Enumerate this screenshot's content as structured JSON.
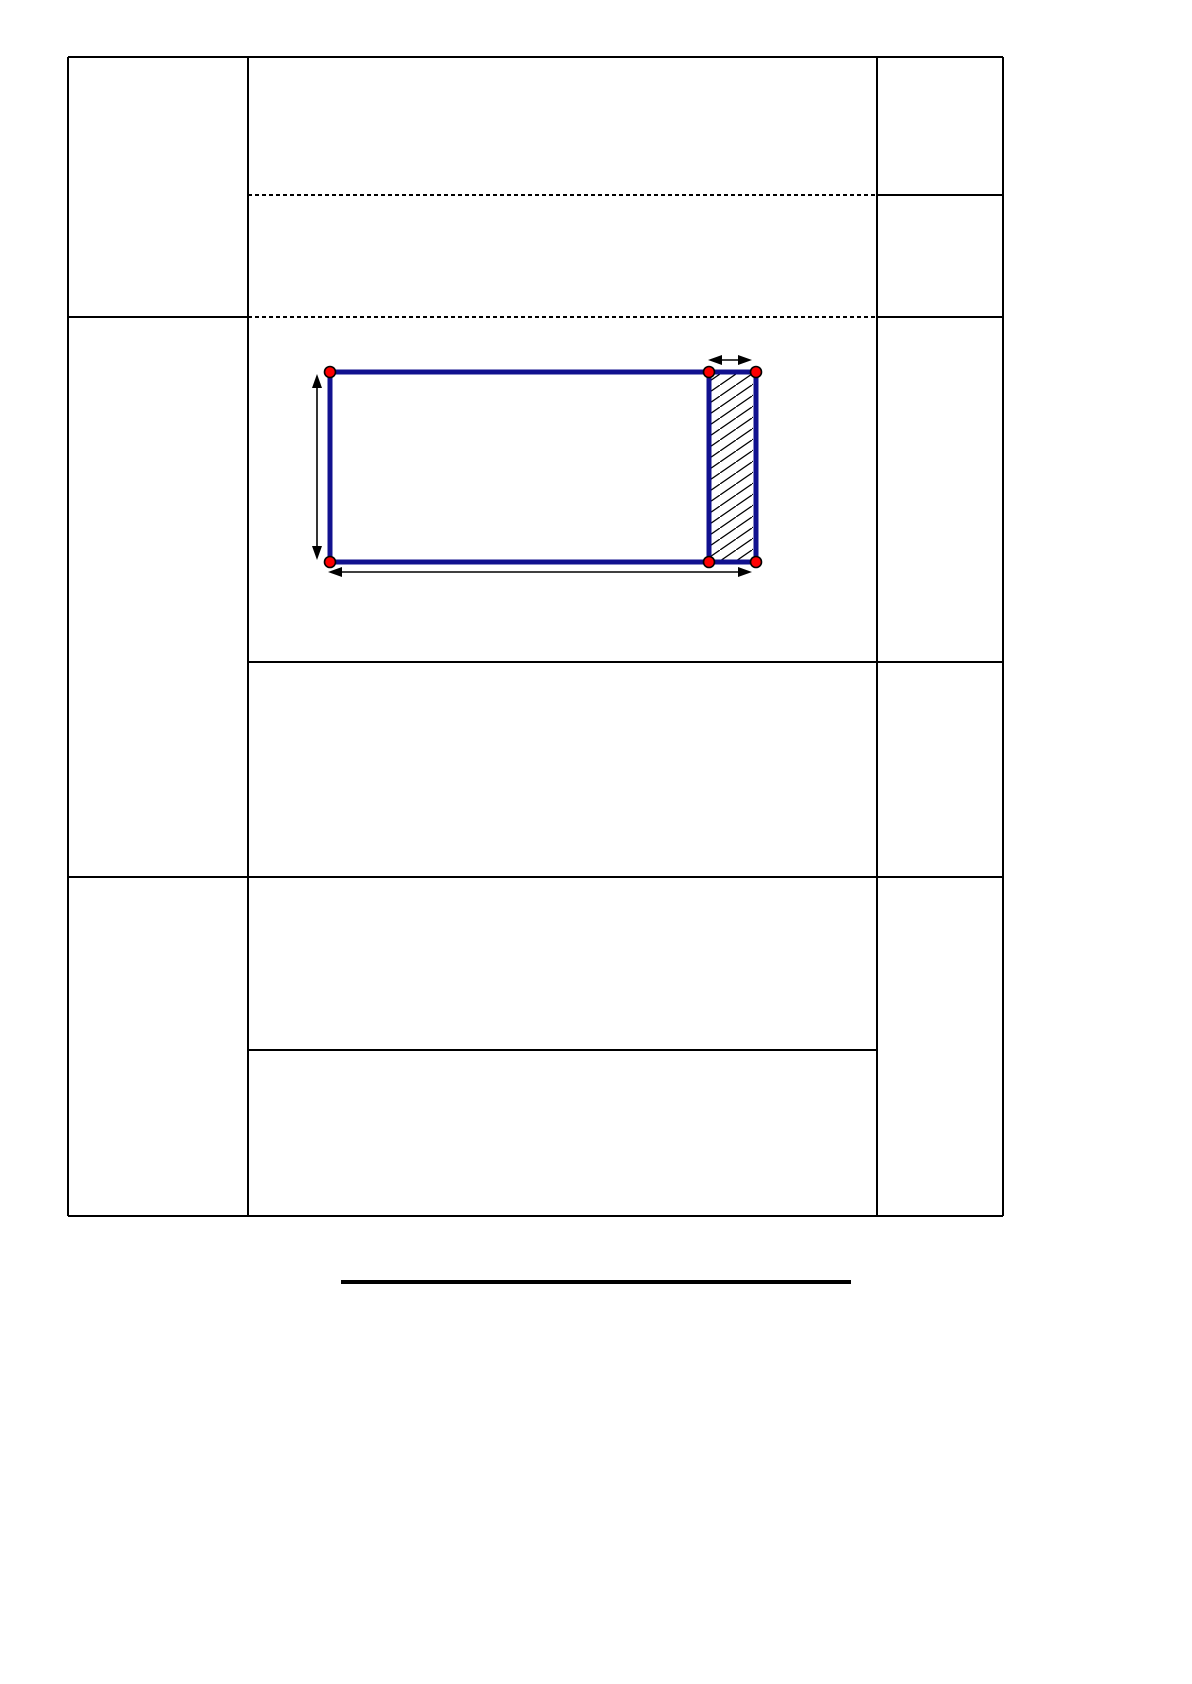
{
  "page": {
    "kind": "document-worksheet-page",
    "background": "#ffffff",
    "visible_text": []
  },
  "colors": {
    "table_border": "#000000",
    "dashed_border": "#000000",
    "diagram_blue": "#11118f",
    "dot_red": "#ff0000",
    "dot_outline": "#000000",
    "hatch_line": "#000000",
    "arrow_black": "#000000",
    "heading_rule": "#000000"
  },
  "table": {
    "x": 68,
    "y": 57,
    "right": 1003,
    "bottom": 1216,
    "column_dividers": [
      248,
      877
    ],
    "vertical_lines": [
      [
        68,
        57,
        1216
      ],
      [
        248,
        57,
        1216
      ],
      [
        877,
        57,
        1216
      ],
      [
        1003,
        57,
        1216
      ]
    ],
    "horizontal_solid": [
      [
        57,
        68,
        1003
      ],
      [
        195,
        877,
        1003
      ],
      [
        317,
        68,
        248
      ],
      [
        317,
        877,
        1003
      ],
      [
        662,
        248,
        1003
      ],
      [
        877,
        68,
        1003
      ],
      [
        1050,
        248,
        877
      ],
      [
        1216,
        68,
        1003
      ]
    ],
    "horizontal_dashed": [
      [
        195,
        248,
        877
      ],
      [
        317,
        248,
        877
      ]
    ],
    "line_weight": 2
  },
  "diagram": {
    "description": "blue rectangle with hatched strip at right end, red vertex dots and dimension arrows",
    "rect": {
      "x": 330,
      "y": 372,
      "width": 426,
      "height": 190,
      "stroke_width": 5
    },
    "inner_line_x": 709,
    "hatch_strip": {
      "x": 711,
      "y": 374,
      "width": 42,
      "height": 186
    },
    "dots": {
      "radius": 5.5,
      "centers": [
        [
          330,
          372
        ],
        [
          709,
          372
        ],
        [
          756,
          372
        ],
        [
          330,
          562
        ],
        [
          709,
          562
        ],
        [
          756,
          562
        ]
      ]
    },
    "arrows": [
      {
        "name": "dimension-arrow-height",
        "type": "v",
        "x": 317,
        "y1": 374,
        "y2": 560
      },
      {
        "name": "dimension-arrow-width",
        "type": "h",
        "y": 572,
        "x1": 328,
        "x2": 752
      },
      {
        "name": "dimension-arrow-strip",
        "type": "h",
        "y": 360,
        "x1": 708,
        "x2": 752
      }
    ],
    "arrow_line_width": 1.6,
    "arrow_head": {
      "length": 14,
      "half_width": 5
    }
  },
  "heading_rule": {
    "x": 341,
    "y": 1280,
    "width": 510,
    "height": 4
  }
}
